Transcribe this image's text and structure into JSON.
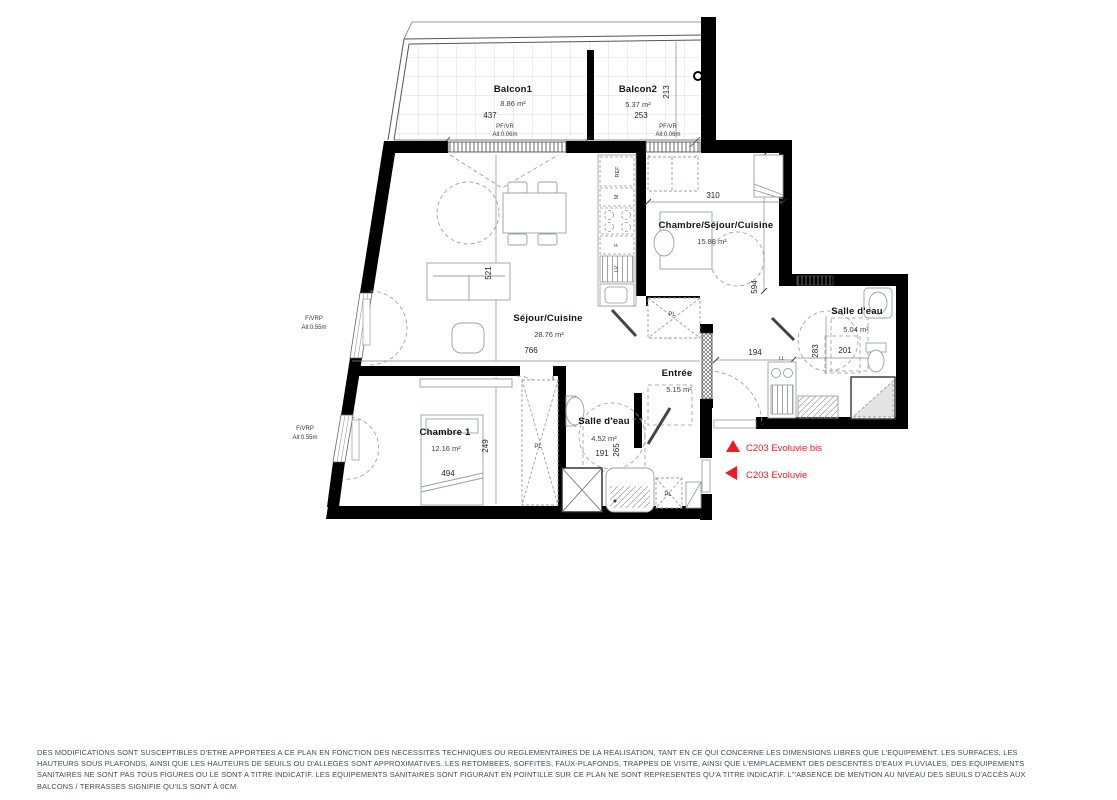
{
  "plan": {
    "rooms": {
      "balcon1": {
        "name": "Balcon1",
        "area": "8.86 m²",
        "width": "437"
      },
      "balcon2": {
        "name": "Balcon2",
        "area": "5.37 m²",
        "width": "253",
        "depth": "213"
      },
      "sejour": {
        "name": "Séjour/Cuisine",
        "area": "28.76 m²",
        "width": "766",
        "depth": "521"
      },
      "studio": {
        "name": "Chambre/Séjour/Cuisine",
        "area": "15.88 m²",
        "width": "310",
        "depth": "594"
      },
      "salle_eau_1": {
        "name": "Salle d'eau",
        "area": "5.04 m²",
        "width": "201",
        "depth": "283"
      },
      "entree": {
        "name": "Entrée",
        "area": "5.15 m²",
        "hall_width": "194"
      },
      "chambre1": {
        "name": "Chambre 1",
        "area": "12.16 m²",
        "width": "494",
        "depth": "249"
      },
      "salle_eau_2": {
        "name": "Salle d'eau",
        "area": "4.52 m²",
        "width": "191",
        "depth": "265"
      }
    },
    "window_labels": {
      "balcony_type": "PF/VR",
      "balcony_sill": "All:0.06m",
      "facade_type": "F/VRP",
      "facade_sill": "All:0.55m"
    },
    "appliance_labels": {
      "fridge": "REF",
      "microwave": "M",
      "oven": "F",
      "dishwasher": "LV",
      "washer": "LL",
      "closet": "PL"
    },
    "annotations": {
      "color": "#ed1c24",
      "items": [
        {
          "label": "C203 Evoluvie bis",
          "marker": "triangle-up"
        },
        {
          "label": "C203 Evoluvie",
          "marker": "triangle-left"
        }
      ]
    }
  },
  "footer": {
    "lines": [
      "DES MODIFICATIONS SONT SUSCEPTIBLES D'ETRE APPORTEES A CE PLAN EN FONCTION DES NECESSITES TECHNIQUES OU REGLEMENTAIRES DE LA REALISATION, TANT EN CE QUI CONCERNE LES DIMENSIONS LIBRES QUE L'EQUIPEMENT. LES SURFACES, LES",
      "HAUTEURS SOUS PLAFONDS, AINSI QUE LES HAUTEURS DE SEUILS OU D'ALLEGES SONT APPROXIMATIVES. LES RETOMBEES, SOFFITES, FAUX-PLAFONDS, TRAPPES DE VISITE, AINSI QUE L'EMPLACEMENT DES DESCENTES D'EAUX PLUVIALES, DES EQUIPEMENTS",
      "SANITAIRES NE SONT PAS TOUS FIGURES OU LE SONT A TITRE INDICATIF. LES EQUIPEMENTS SANITAIRES SONT FIGURANT EN POINTILLE SUR CE PLAN NE SONT REPRESENTES QU'A TITRE INDICATIF. L'\"ABSENCE DE MENTION AU NIVEAU DES SEUILS D'ACCÈS AUX",
      "BALCONS / TERRASSES SIGNIFIE QU'ILS SONT À 0CM."
    ]
  }
}
